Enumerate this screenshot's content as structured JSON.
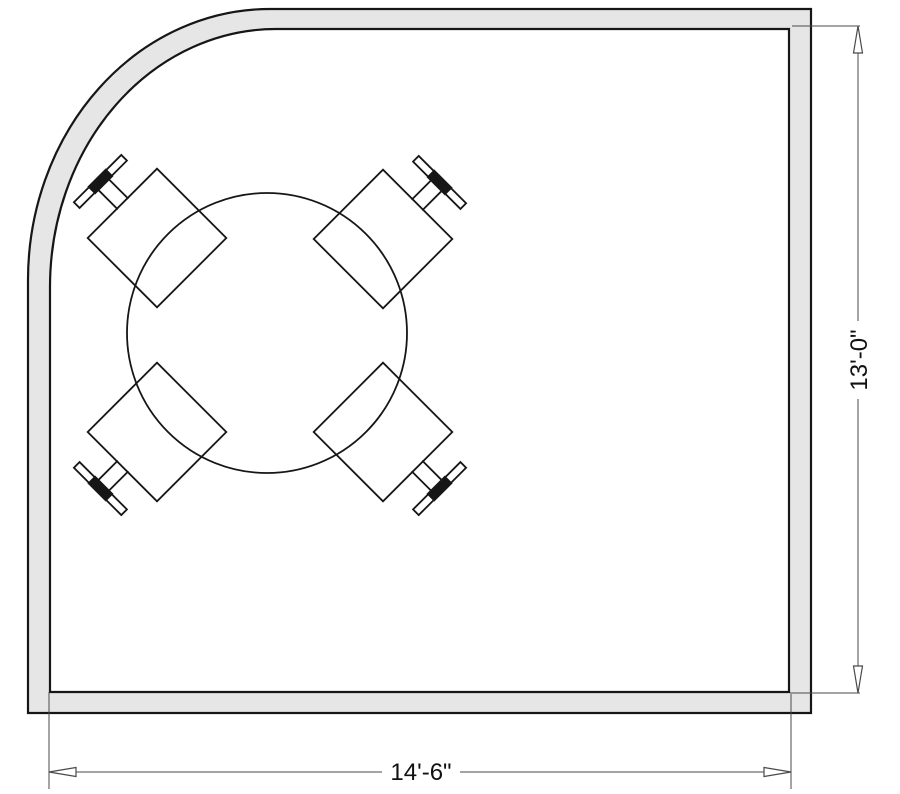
{
  "drawing": {
    "kind": "floor-plan",
    "description": "Room plan with quarter-round top-left corner wall, round table with four chairs, and two dimension strings"
  },
  "dimensions": {
    "width_label": "14'-6\"",
    "height_label": "13'-0\""
  },
  "furniture": {
    "table": {
      "name": "round-table"
    },
    "chairs": [
      {
        "name": "chair",
        "position": "northwest"
      },
      {
        "name": "chair",
        "position": "northeast"
      },
      {
        "name": "chair",
        "position": "southwest"
      },
      {
        "name": "chair",
        "position": "southeast"
      }
    ]
  },
  "colors": {
    "background": "#ffffff",
    "wall_fill": "#e6e6e6",
    "line": "#161616",
    "dimension_line": "#4a4a4a"
  }
}
